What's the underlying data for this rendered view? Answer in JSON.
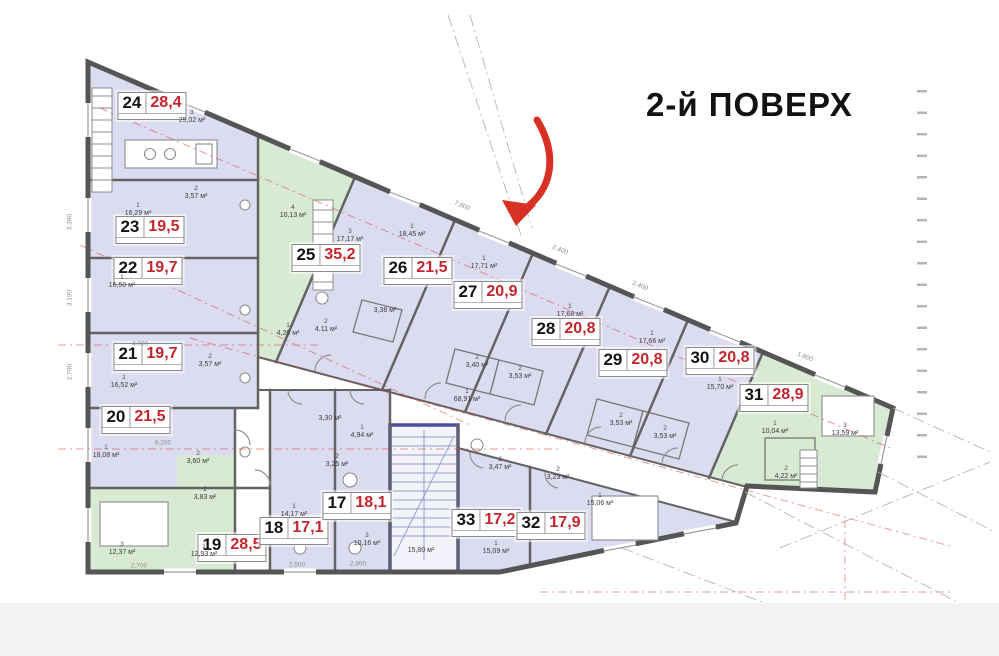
{
  "title": "2-й ПОВЕРХ",
  "colors": {
    "room_lavender": "#dcdcf1",
    "room_green": "#d8ead3",
    "wall": "#5c5c5c",
    "stair_border": "#4c4f9e",
    "area_red": "#c2262c",
    "arrow_red": "#d93025",
    "axis_red": "#cf3a34"
  },
  "apartments": [
    {
      "id": "24",
      "area": "28,4",
      "x": 152,
      "y": 106
    },
    {
      "id": "23",
      "area": "19,5",
      "x": 150,
      "y": 230
    },
    {
      "id": "22",
      "area": "19,7",
      "x": 148,
      "y": 271
    },
    {
      "id": "21",
      "area": "19,7",
      "x": 148,
      "y": 357
    },
    {
      "id": "20",
      "area": "21,5",
      "x": 136,
      "y": 420
    },
    {
      "id": "19",
      "area": "28,5",
      "x": 232,
      "y": 548
    },
    {
      "id": "18",
      "area": "17,1",
      "x": 294,
      "y": 531
    },
    {
      "id": "17",
      "area": "18,1",
      "x": 357,
      "y": 506
    },
    {
      "id": "25",
      "area": "35,2",
      "x": 326,
      "y": 258
    },
    {
      "id": "26",
      "area": "21,5",
      "x": 418,
      "y": 271
    },
    {
      "id": "27",
      "area": "20,9",
      "x": 488,
      "y": 295
    },
    {
      "id": "28",
      "area": "20,8",
      "x": 566,
      "y": 332
    },
    {
      "id": "29",
      "area": "20,8",
      "x": 633,
      "y": 363
    },
    {
      "id": "30",
      "area": "20,8",
      "x": 720,
      "y": 361
    },
    {
      "id": "31",
      "area": "28,9",
      "x": 774,
      "y": 398
    },
    {
      "id": "33",
      "area": "17,2",
      "x": 486,
      "y": 523
    },
    {
      "id": "32",
      "area": "17,9",
      "x": 551,
      "y": 526
    }
  ],
  "room_labels": [
    {
      "n": "3",
      "a": "25,02 м²",
      "x": 192,
      "y": 117
    },
    {
      "n": "1",
      "a": "16,29 м²",
      "x": 138,
      "y": 210
    },
    {
      "n": "2",
      "a": "3,57 м²",
      "x": 196,
      "y": 193
    },
    {
      "n": "1",
      "a": "16,50 м²",
      "x": 122,
      "y": 282
    },
    {
      "n": "1",
      "a": "16,52 м²",
      "x": 124,
      "y": 382
    },
    {
      "n": "2",
      "a": "3,57 м²",
      "x": 210,
      "y": 361
    },
    {
      "n": "1",
      "a": "18,08 м²",
      "x": 106,
      "y": 452
    },
    {
      "n": "2",
      "a": "3,60 м²",
      "x": 198,
      "y": 458
    },
    {
      "n": "2",
      "a": "3,83 м²",
      "x": 205,
      "y": 494
    },
    {
      "n": "3",
      "a": "12,37 м²",
      "x": 122,
      "y": 549
    },
    {
      "n": "1",
      "a": "12,93 м²",
      "x": 204,
      "y": 551
    },
    {
      "n": "1",
      "a": "14,17 м²",
      "x": 294,
      "y": 511
    },
    {
      "n": "2",
      "a": "3,25 м²",
      "x": 337,
      "y": 461
    },
    {
      "n": "",
      "a": "3,30 м²",
      "x": 330,
      "y": 419
    },
    {
      "n": "3",
      "a": "10,16 м²",
      "x": 367,
      "y": 540
    },
    {
      "n": "1",
      "a": "4,94 м²",
      "x": 362,
      "y": 432
    },
    {
      "n": "",
      "a": "15,80 м²",
      "x": 421,
      "y": 551
    },
    {
      "n": "2",
      "a": "3,47 м²",
      "x": 500,
      "y": 464
    },
    {
      "n": "1",
      "a": "15,09 м²",
      "x": 496,
      "y": 548
    },
    {
      "n": "2",
      "a": "3,23 м²",
      "x": 558,
      "y": 474
    },
    {
      "n": "1",
      "a": "15,06 м²",
      "x": 600,
      "y": 500
    },
    {
      "n": "4",
      "a": "10,13 м²",
      "x": 293,
      "y": 212
    },
    {
      "n": "3",
      "a": "17,17 м²",
      "x": 350,
      "y": 236
    },
    {
      "n": "2",
      "a": "4,11 м²",
      "x": 326,
      "y": 326
    },
    {
      "n": "1",
      "a": "4,20 м²",
      "x": 288,
      "y": 330
    },
    {
      "n": "1",
      "a": "18,45 м²",
      "x": 412,
      "y": 231
    },
    {
      "n": "",
      "a": "3,38 м²",
      "x": 385,
      "y": 311
    },
    {
      "n": "1",
      "a": "17,71 м²",
      "x": 484,
      "y": 263
    },
    {
      "n": "2",
      "a": "3,40 м²",
      "x": 477,
      "y": 362
    },
    {
      "n": "1",
      "a": "17,68 м²",
      "x": 570,
      "y": 311
    },
    {
      "n": "2",
      "a": "3,53 м²",
      "x": 520,
      "y": 373
    },
    {
      "n": "1",
      "a": "17,66 м²",
      "x": 652,
      "y": 338
    },
    {
      "n": "2",
      "a": "3,53 м²",
      "x": 621,
      "y": 420
    },
    {
      "n": "1",
      "a": "15,70 м²",
      "x": 720,
      "y": 384
    },
    {
      "n": "2",
      "a": "3,53 м²",
      "x": 665,
      "y": 433
    },
    {
      "n": "1",
      "a": "10,04 м²",
      "x": 775,
      "y": 428
    },
    {
      "n": "2",
      "a": "4,22 м²",
      "x": 786,
      "y": 473
    },
    {
      "n": "3",
      "a": "13,59 м²",
      "x": 845,
      "y": 430
    },
    {
      "n": "1",
      "a": "68,91 м²",
      "x": 467,
      "y": 396
    }
  ],
  "dims": [
    {
      "t": "2.700",
      "x": 139,
      "y": 566,
      "r": 0
    },
    {
      "t": "2.500",
      "x": 297,
      "y": 565,
      "r": 0
    },
    {
      "t": "2.800",
      "x": 358,
      "y": 564,
      "r": 0
    },
    {
      "t": "6.200",
      "x": 163,
      "y": 443,
      "r": 0
    },
    {
      "t": "4.000",
      "x": 140,
      "y": 344,
      "r": 0
    },
    {
      "t": "3.390",
      "x": 70,
      "y": 222,
      "r": -90
    },
    {
      "t": "3.190",
      "x": 70,
      "y": 298,
      "r": -90
    },
    {
      "t": "2.700",
      "x": 70,
      "y": 372,
      "r": -90
    },
    {
      "t": "7.800",
      "x": 462,
      "y": 206,
      "r": 23
    },
    {
      "t": "2.400",
      "x": 560,
      "y": 250,
      "r": 23
    },
    {
      "t": "2.400",
      "x": 640,
      "y": 286,
      "r": 23
    },
    {
      "t": "1.800",
      "x": 805,
      "y": 357,
      "r": 23
    }
  ]
}
